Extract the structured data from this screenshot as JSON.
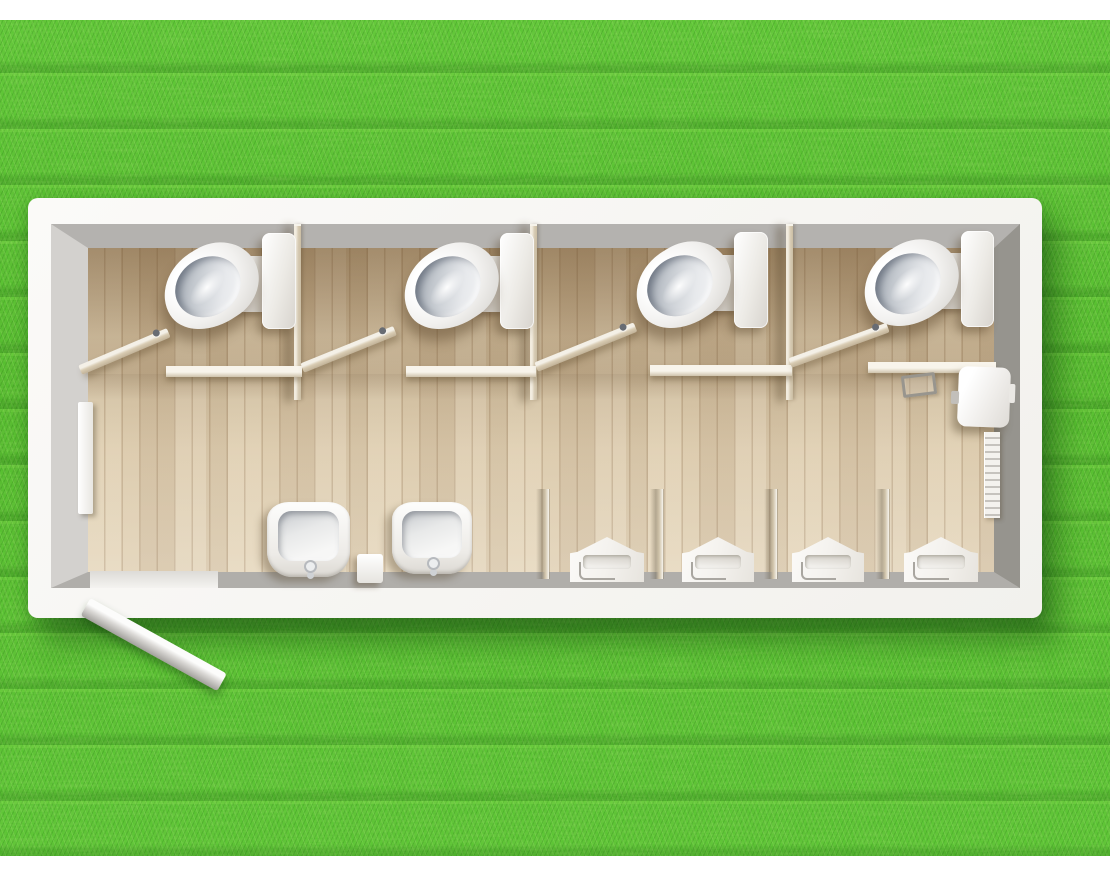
{
  "scene": {
    "description": "Top-down 3D architectural rendering of a portable sanitary container (toilet block) standing on a grass lawn",
    "environment": "grass lawn with white page margins top and bottom",
    "view": "plan view / bird's eye",
    "text_content": "none (image contains no visible text)"
  },
  "colors": {
    "page_margin": "#ffffff",
    "grass_base": "#58bb2e",
    "grass_dark": "#2f8a12",
    "grass_light": "#8ae14b",
    "container_wall_white": "#f6f5f2",
    "wall_face_top": "#b4b2af",
    "wall_face_left": "#d3d1ce",
    "wall_face_right": "#96948e",
    "wall_face_bottom": "#b0aeaa",
    "floor_wood_light": "#e2d2b6",
    "floor_wood_dark": "#c4ae8c",
    "partition_tan": "#d9cdb6",
    "ceramic_white": "#f4f2ef",
    "ceramic_bowl_inner": "#c4c9cf"
  },
  "inventory": {
    "toilet_cubicles": 4,
    "toilets": 4,
    "cisterns": 4,
    "cubicle_doors_open": 4,
    "cubicle_partitions": 3,
    "wash_basins": 2,
    "urinals": 4,
    "urinal_dividers": 4,
    "entrance_doors_open": 1,
    "wall_panels": 1,
    "wall_mounted_units": 1
  },
  "fixtures": [
    {
      "name": "cubicle-partition-1",
      "type": "partition",
      "x": 294,
      "y": 224,
      "w": 7,
      "h": 176
    },
    {
      "name": "cubicle-partition-2",
      "type": "partition",
      "x": 530,
      "y": 224,
      "w": 7,
      "h": 176
    },
    {
      "name": "cubicle-partition-3",
      "type": "partition",
      "x": 786,
      "y": 224,
      "w": 7,
      "h": 176
    },
    {
      "name": "cubicle-front-wall-1",
      "type": "front-wall",
      "x": 166,
      "y": 366,
      "w": 136,
      "h": 11
    },
    {
      "name": "cubicle-front-wall-2",
      "type": "front-wall",
      "x": 406,
      "y": 366,
      "w": 130,
      "h": 11
    },
    {
      "name": "cubicle-front-wall-3",
      "type": "front-wall",
      "x": 650,
      "y": 365,
      "w": 142,
      "h": 11
    },
    {
      "name": "cubicle-front-wall-4",
      "type": "front-wall",
      "x": 868,
      "y": 362,
      "w": 128,
      "h": 11
    },
    {
      "name": "entrance-threshold",
      "type": "threshold",
      "x": 90,
      "y": 571,
      "w": 128,
      "h": 17
    },
    {
      "name": "toilet-seat-hinge-1",
      "type": "seat-tab",
      "x": 234,
      "y": 256,
      "w": 32,
      "h": 56
    },
    {
      "name": "toilet-seat-hinge-2",
      "type": "seat-tab",
      "x": 474,
      "y": 256,
      "w": 32,
      "h": 56
    },
    {
      "name": "toilet-seat-hinge-3",
      "type": "seat-tab",
      "x": 706,
      "y": 255,
      "w": 32,
      "h": 56
    },
    {
      "name": "toilet-seat-hinge-4",
      "type": "seat-tab",
      "x": 934,
      "y": 253,
      "w": 32,
      "h": 56
    },
    {
      "name": "cistern-1",
      "type": "cistern",
      "x": 262,
      "y": 233,
      "w": 34,
      "h": 96
    },
    {
      "name": "cistern-2",
      "type": "cistern",
      "x": 500,
      "y": 233,
      "w": 34,
      "h": 96
    },
    {
      "name": "cistern-3",
      "type": "cistern",
      "x": 734,
      "y": 232,
      "w": 34,
      "h": 96
    },
    {
      "name": "cistern-4",
      "type": "cistern",
      "x": 961,
      "y": 231,
      "w": 33,
      "h": 96
    },
    {
      "name": "toilet-1",
      "type": "toilet",
      "x": 161,
      "y": 247,
      "w": 100,
      "h": 78,
      "rot": -32
    },
    {
      "name": "toilet-2",
      "type": "toilet",
      "x": 401,
      "y": 247,
      "w": 100,
      "h": 78,
      "rot": -32
    },
    {
      "name": "toilet-3",
      "type": "toilet",
      "x": 633,
      "y": 246,
      "w": 100,
      "h": 78,
      "rot": -32
    },
    {
      "name": "toilet-4",
      "type": "toilet",
      "x": 861,
      "y": 244,
      "w": 100,
      "h": 78,
      "rot": -32
    },
    {
      "name": "cubicle-door-1",
      "type": "cubicle-door",
      "x": 80,
      "y": 364,
      "w": 96,
      "h": 10,
      "rot": -23
    },
    {
      "name": "cubicle-door-2",
      "type": "cubicle-door",
      "x": 302,
      "y": 362,
      "w": 100,
      "h": 10,
      "rot": -22
    },
    {
      "name": "cubicle-door-3",
      "type": "cubicle-door",
      "x": 536,
      "y": 361,
      "w": 107,
      "h": 10,
      "rot": -22
    },
    {
      "name": "cubicle-door-4",
      "type": "cubicle-door",
      "x": 790,
      "y": 357,
      "w": 104,
      "h": 10,
      "rot": -20
    },
    {
      "name": "left-wall-panel",
      "type": "wall-panel",
      "x": 78,
      "y": 402,
      "w": 15,
      "h": 112
    },
    {
      "name": "wall-mounted-unit",
      "type": "wall-box",
      "x": 958,
      "y": 367,
      "w": 52,
      "h": 60,
      "rot": 2
    },
    {
      "name": "wall-strip-radiator",
      "type": "drip-strip",
      "x": 984,
      "y": 432,
      "w": 16,
      "h": 86
    },
    {
      "name": "floor-drain-frame",
      "type": "floor-tray",
      "x": 902,
      "y": 374,
      "w": 34,
      "h": 22,
      "rot": -7
    },
    {
      "name": "wash-basin-1",
      "type": "sink",
      "x": 267,
      "y": 502,
      "w": 83,
      "h": 75
    },
    {
      "name": "wash-basin-2",
      "type": "sink",
      "x": 392,
      "y": 502,
      "w": 80,
      "h": 72
    },
    {
      "name": "between-sink-block",
      "type": "counter-block",
      "x": 357,
      "y": 554,
      "w": 26,
      "h": 29
    },
    {
      "name": "urinal-divider-1",
      "type": "urinal-divider",
      "x": 536,
      "y": 489,
      "w": 13,
      "h": 90
    },
    {
      "name": "urinal-divider-2",
      "type": "urinal-divider",
      "x": 650,
      "y": 489,
      "w": 13,
      "h": 90
    },
    {
      "name": "urinal-divider-3",
      "type": "urinal-divider",
      "x": 764,
      "y": 489,
      "w": 13,
      "h": 90
    },
    {
      "name": "urinal-divider-4",
      "type": "urinal-divider",
      "x": 876,
      "y": 489,
      "w": 13,
      "h": 90
    },
    {
      "name": "urinal-1",
      "type": "urinal",
      "x": 570,
      "y": 537,
      "w": 74,
      "h": 45
    },
    {
      "name": "urinal-2",
      "type": "urinal",
      "x": 682,
      "y": 537,
      "w": 72,
      "h": 45
    },
    {
      "name": "urinal-3",
      "type": "urinal",
      "x": 792,
      "y": 537,
      "w": 72,
      "h": 45
    },
    {
      "name": "urinal-4",
      "type": "urinal",
      "x": 904,
      "y": 537,
      "w": 74,
      "h": 45
    },
    {
      "name": "entrance-door-open",
      "type": "entry-door",
      "x": 86,
      "y": 599,
      "w": 156,
      "h": 20,
      "rot": 29
    }
  ]
}
